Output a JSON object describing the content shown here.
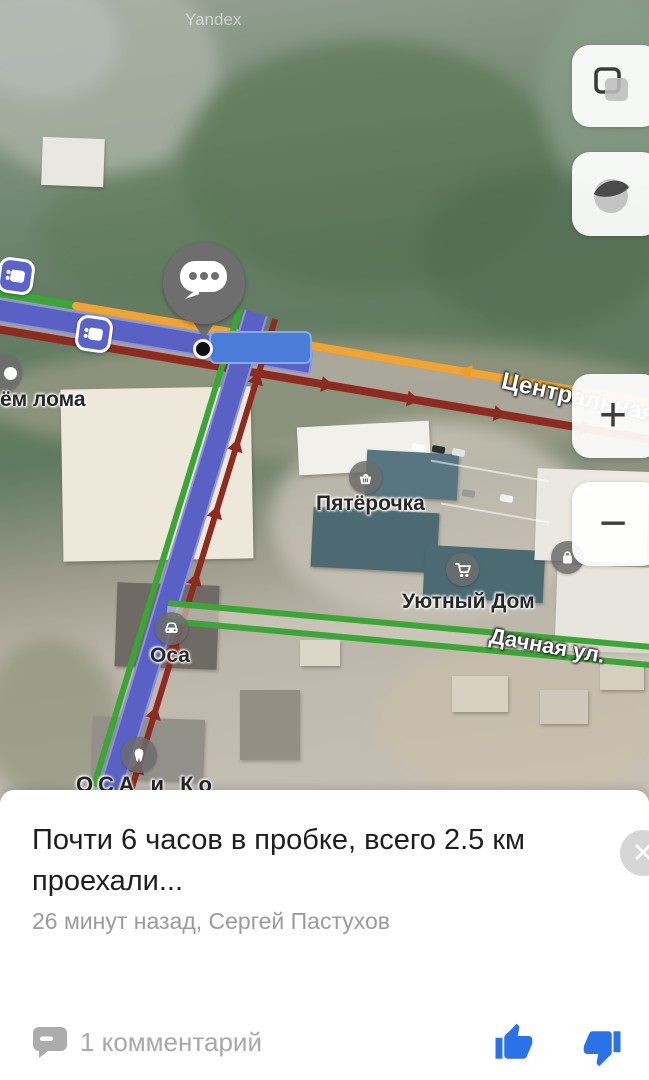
{
  "map": {
    "watermark": "Yandex",
    "road_labels": {
      "central": "Центральная",
      "dachnaya": "Дачная ул."
    },
    "pois": {
      "priem_loma": "ём лома",
      "pyaterochka": "Пятёрочка",
      "uyutny_dom": "Уютный Дом",
      "osa": "Оса",
      "osa_ko": "ОСА и Ко"
    },
    "controls": {
      "zoom_in": "+",
      "zoom_out": "−"
    },
    "colors": {
      "traffic_green": "#3aa636",
      "traffic_orange": "#f2a432",
      "traffic_red": "#8e2a20",
      "route_purple": "#5a61c4",
      "highlight_blue": "#4a7dd7"
    }
  },
  "panel": {
    "title": "Почти 6 часов в пробке, всего 2.5 км проехали...",
    "meta": "26 минут назад, Сергей Пастухов",
    "close": "✕",
    "comments_label": "1 комментарий",
    "accent_blue": "#2b72e9"
  }
}
